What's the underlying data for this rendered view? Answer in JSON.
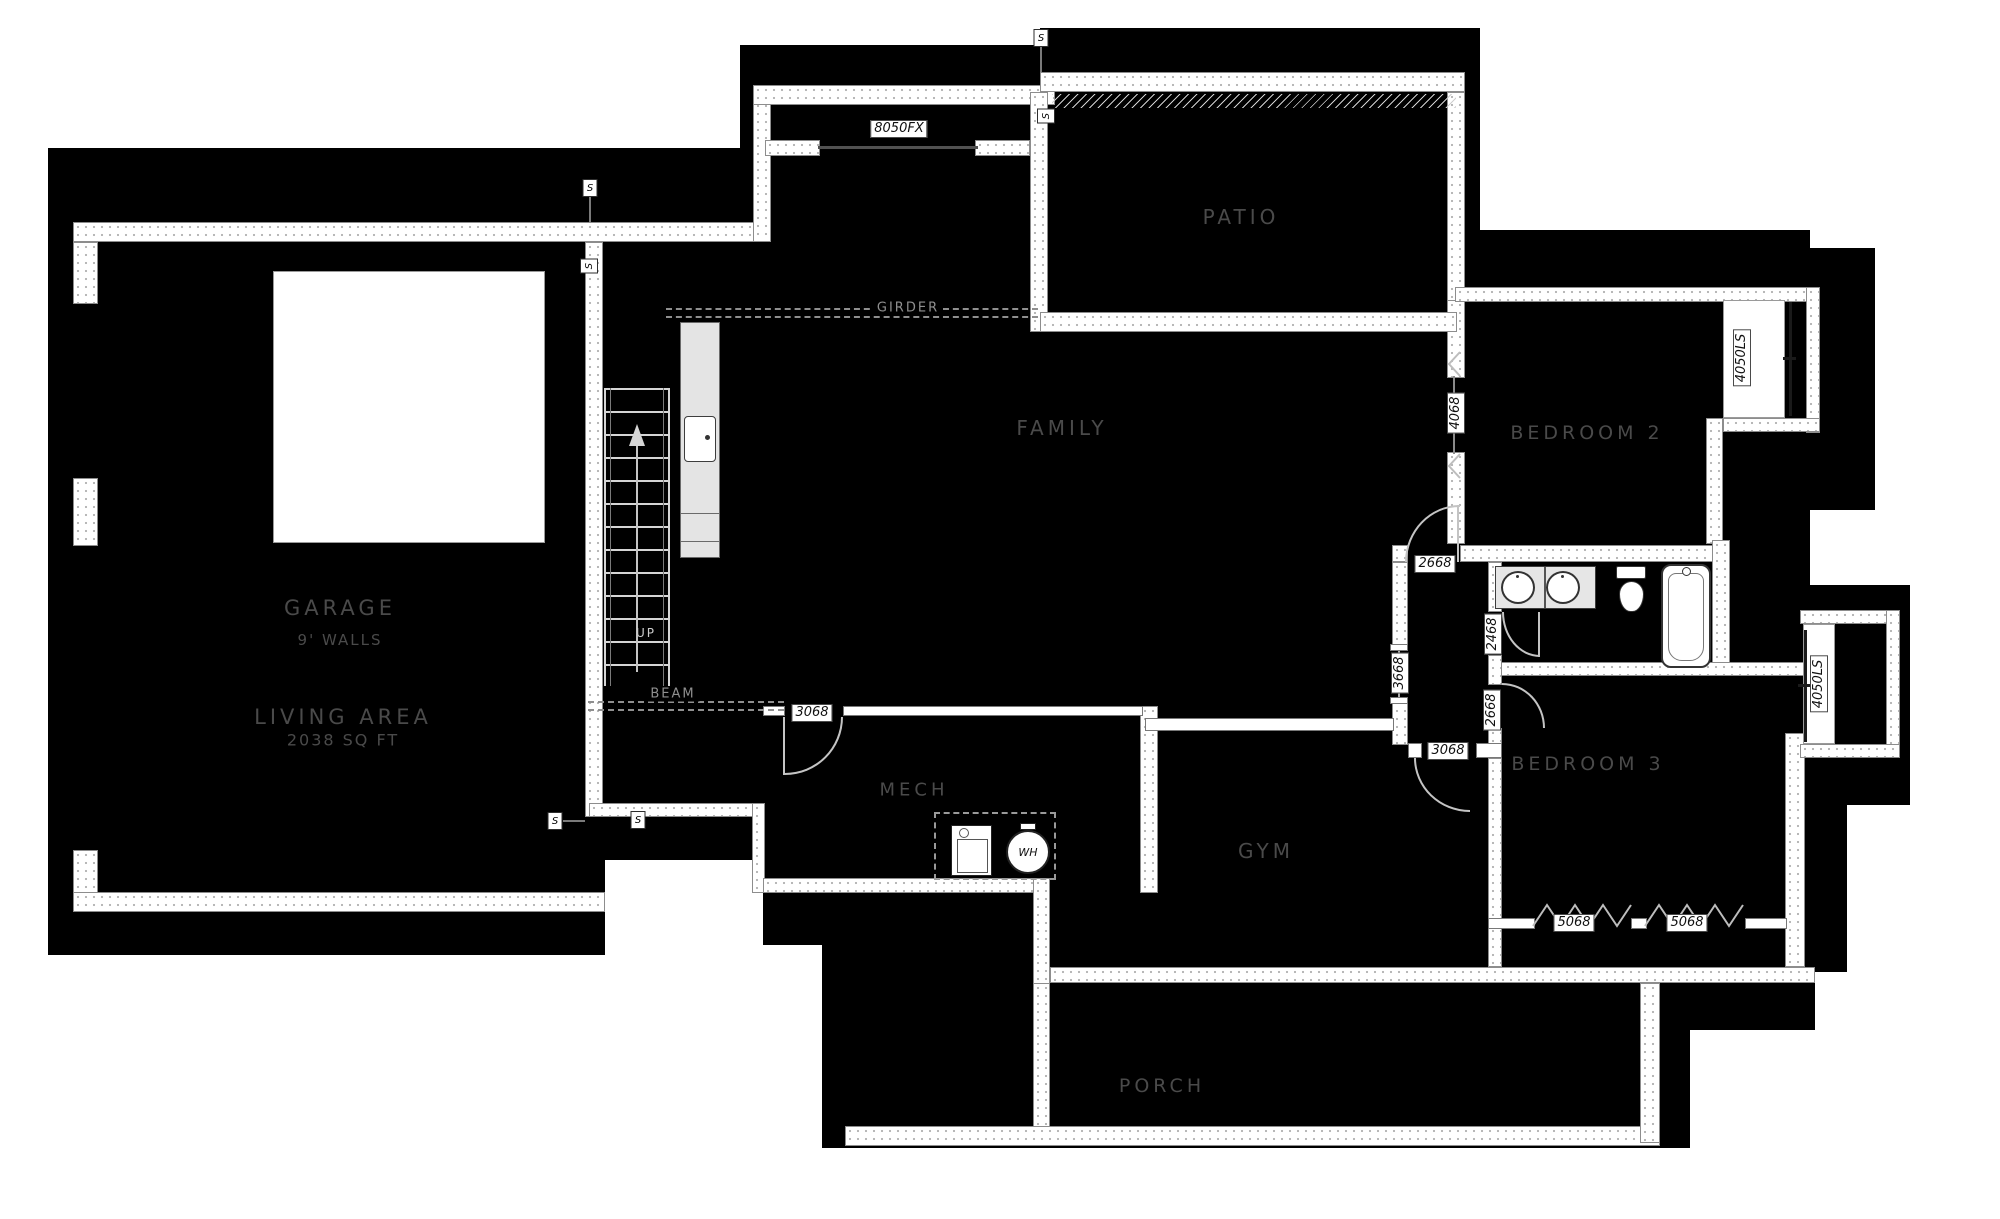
{
  "rooms": {
    "garage": {
      "label": "GARAGE",
      "sub": "9' WALLS"
    },
    "living": {
      "label": "LIVING AREA",
      "sub": "2038 SQ FT"
    },
    "family": {
      "label": "FAMILY"
    },
    "patio": {
      "label": "PATIO"
    },
    "bedroom2": {
      "label": "BEDROOM 2"
    },
    "bedroom3": {
      "label": "BEDROOM 3"
    },
    "mech": {
      "label": "MECH"
    },
    "gym": {
      "label": "GYM"
    },
    "porch": {
      "label": "PORCH"
    }
  },
  "annotations": {
    "girder": "GIRDER",
    "beam": "BEAM",
    "stairs_up": "UP",
    "water_heater": "WH",
    "switch": "S"
  },
  "openings": {
    "family_north_window": "8050FX",
    "bedroom2_window": "4068",
    "bedroom2_bay_window": "4050LS",
    "bedroom3_bay_window": "4050LS",
    "hall_door": "2668",
    "bath_door": "2468",
    "bedroom3_door": "2668",
    "hall_window": "3668",
    "gym_door": "3068",
    "mech_door": "3068",
    "bedroom3_window_a": "5068",
    "bedroom3_window_b": "5068"
  },
  "colors": {
    "page_background": "#ffffff",
    "floor_fill": "#000000",
    "wall_fill": "#ffffff",
    "wall_edge": "#8d8d8d",
    "room_label": "#4a4a4a",
    "annotation": "#8f8f8f",
    "dimension_text": "#111111",
    "counter": "#e4e4e4"
  }
}
